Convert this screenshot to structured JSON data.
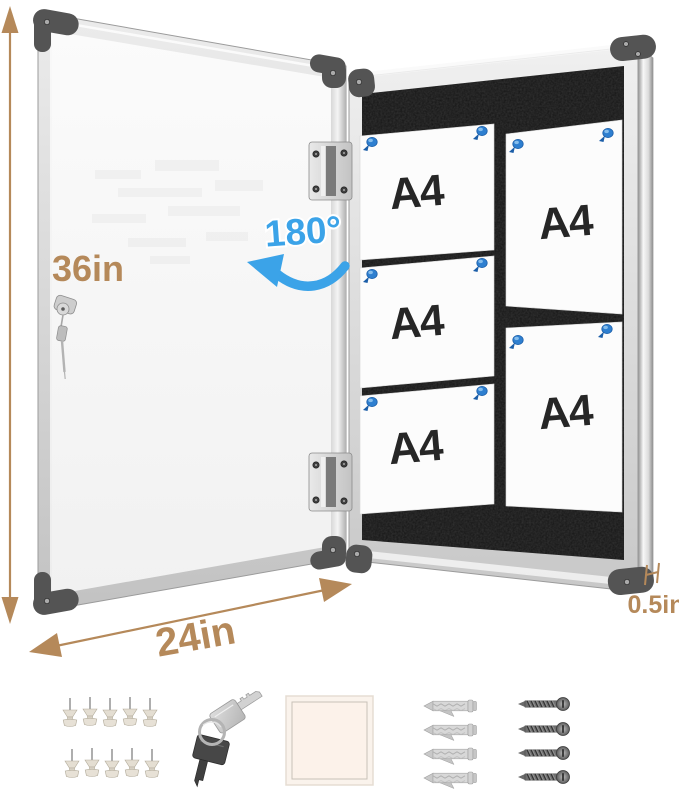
{
  "annotations": {
    "height": "36in",
    "width": "24in",
    "depth": "0.5in",
    "open_angle": "180°"
  },
  "board": {
    "surface": "black felt",
    "papers": [
      {
        "label": "A4",
        "orientation": "landscape"
      },
      {
        "label": "A4",
        "orientation": "landscape"
      },
      {
        "label": "A4",
        "orientation": "landscape"
      },
      {
        "label": "A4",
        "orientation": "portrait"
      },
      {
        "label": "A4",
        "orientation": "portrait"
      }
    ],
    "board_pin_count": 10
  },
  "door": {
    "has_lock": true,
    "hinge_count": 2
  },
  "accessories": [
    {
      "name": "push-pins",
      "count": 10
    },
    {
      "name": "keys",
      "count": 2
    },
    {
      "name": "adhesive-pad",
      "count": 1
    },
    {
      "name": "wall-anchors",
      "count": 4
    },
    {
      "name": "screws",
      "count": 4
    }
  ],
  "colors": {
    "dimension_text": "#b5895a",
    "angle_text": "#3ba3e8",
    "pin_blue": "#2e7fd0",
    "frame_silver": "#d9d9d9",
    "felt_black": "#151515"
  }
}
